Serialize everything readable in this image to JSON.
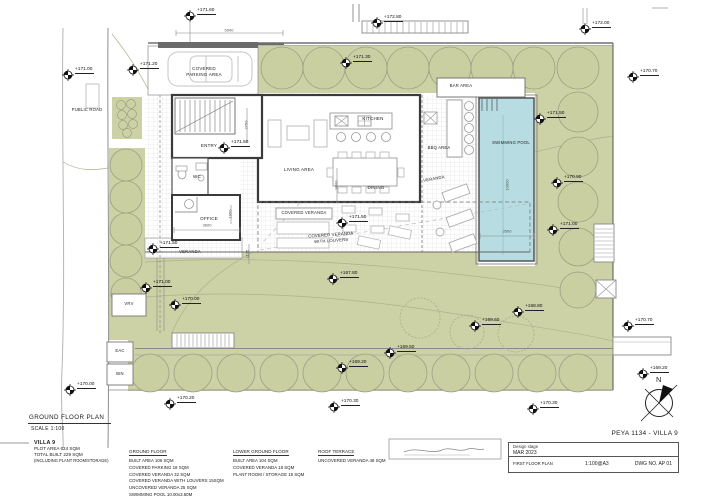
{
  "plan": {
    "title": "GROUND FLOOR PLAN",
    "scale": "SCALE 1:100",
    "north_label": "N"
  },
  "labels": {
    "public_road": "PUBLIC ROAD",
    "covered_parking_line1": "COVERED",
    "covered_parking_line2": "PARKING AREA",
    "bar_area": "BAR AREA",
    "kitchen": "KITCHEN",
    "entry": "ENTRY",
    "living_area": "LIVING AREA",
    "wc": "WC",
    "dining": "DINING",
    "veranda_bbq": "VERANDA",
    "office": "OFFICE",
    "covered_veranda": "COVERED VERANDA",
    "cv_louvers_line1": "COVERED VERANDA",
    "cv_louvers_line2": "WITH LOUVERS",
    "veranda_left": "VERANDA",
    "swimming_pool": "SWIMMING POOL",
    "bbq_area": "BBQ AREA",
    "vrv": "VRV",
    "eac": "EAC",
    "bin": "BIN"
  },
  "levels": [
    "+171.60",
    "+172.80",
    "+172.00",
    "+171.00",
    "+171.20",
    "+171.30",
    "+170.70",
    "+171.50",
    "+171.50",
    "+170.90",
    "+171.00",
    "+171.50",
    "+171.50",
    "+171.00",
    "+170.00",
    "+167.80",
    "+168.80",
    "+169.60",
    "+170.70",
    "+169.20",
    "+169.50",
    "+169.20",
    "+170.30",
    "+170.30",
    "+170.00",
    "+170.20"
  ],
  "dimensions": [
    "5000",
    "2750",
    "9600",
    "1950",
    "3600",
    "1135",
    "10000",
    "3500"
  ],
  "summary": {
    "title": "VILLA 9",
    "lines": [
      "PLOT AREA 624 SQM",
      "TOTAL BUILT 229 SQM",
      "(INCLUDING PLANT ROOM/STORAGE)"
    ]
  },
  "schedule": {
    "columns": [
      {
        "title": "GROUND FLOOR",
        "lines": [
          "BUILT AREA 106 SQM",
          "COVERED PARKING 18 SQM",
          "COVERED VERANDA 32 SQM",
          "COVERED VERANDA WITH LOUVERS 15SQM",
          "UNCOVERED VERANDA 25 SQM",
          "SWIMMING POOL 10.00x3.50M"
        ]
      },
      {
        "title": "LOWER GROUND FLOOR",
        "lines": [
          "BUILT AREA 104 SQM",
          "COVERED VERANDA 18 SQM",
          "PLANT ROOM / STORAGE 19 SQM"
        ]
      },
      {
        "title": "ROOF TERRACE",
        "lines": [
          "UNCOVERED VERANDA 48 SQM"
        ]
      }
    ]
  },
  "title_block": {
    "project": "PEYA 1134 - VILLA 9",
    "stage_label": "Design stage",
    "stage_date": "MAR 2023",
    "drawing_title": "FIRST FLOOR PLAN",
    "print_scale": "1:100@A3",
    "dwg_no": "DWG NO. AP 01"
  },
  "colors": {
    "landscape_green": "#cdd1a6",
    "pool_blue": "#b7dde2",
    "wall_dark": "#3a3a3a"
  }
}
